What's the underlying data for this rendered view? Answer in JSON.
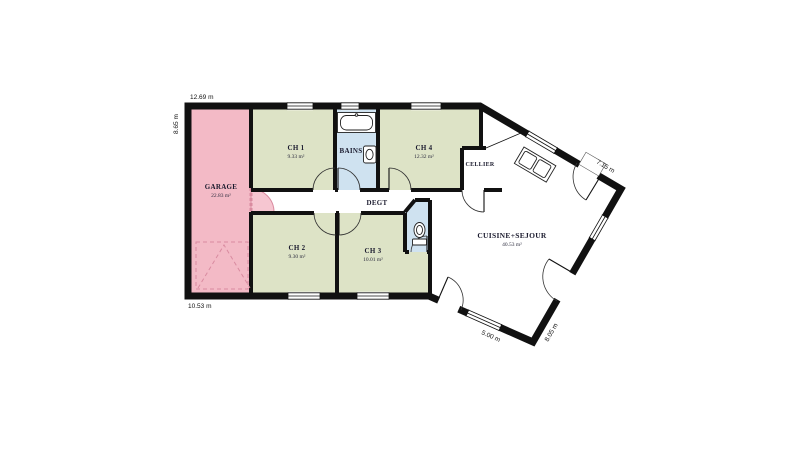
{
  "plan": {
    "rooms": {
      "garage": {
        "label": "GARAGE",
        "area": "22.83 m²"
      },
      "ch1": {
        "label": "CH 1",
        "area": "9.33 m²"
      },
      "bains": {
        "label": "BAINS",
        "area": ""
      },
      "ch4": {
        "label": "CH 4",
        "area": "12.32 m²"
      },
      "cellier": {
        "label": "CELLIER",
        "area": ""
      },
      "degt": {
        "label": "DEGT",
        "area": ""
      },
      "ch2": {
        "label": "CH 2",
        "area": "9.30 m²"
      },
      "ch3": {
        "label": "CH 3",
        "area": "10.01 m²"
      },
      "sejour": {
        "label": "CUISINE+SEJOUR",
        "area": "40.53 m²"
      }
    },
    "dimensions": {
      "top": "12.69 m",
      "left": "8.65 m",
      "bottom_left": "10.53 m",
      "upper_right": "7.15 m",
      "bottom_center": "5.00 m",
      "bottom_right": "8.05 m"
    },
    "colors": {
      "garage": "#f3bac6",
      "bedroom": "#dde3c6",
      "water": "#cfe2f0",
      "wall": "#111111",
      "background": "#ffffff",
      "garage_door": "#d98ba0"
    }
  }
}
